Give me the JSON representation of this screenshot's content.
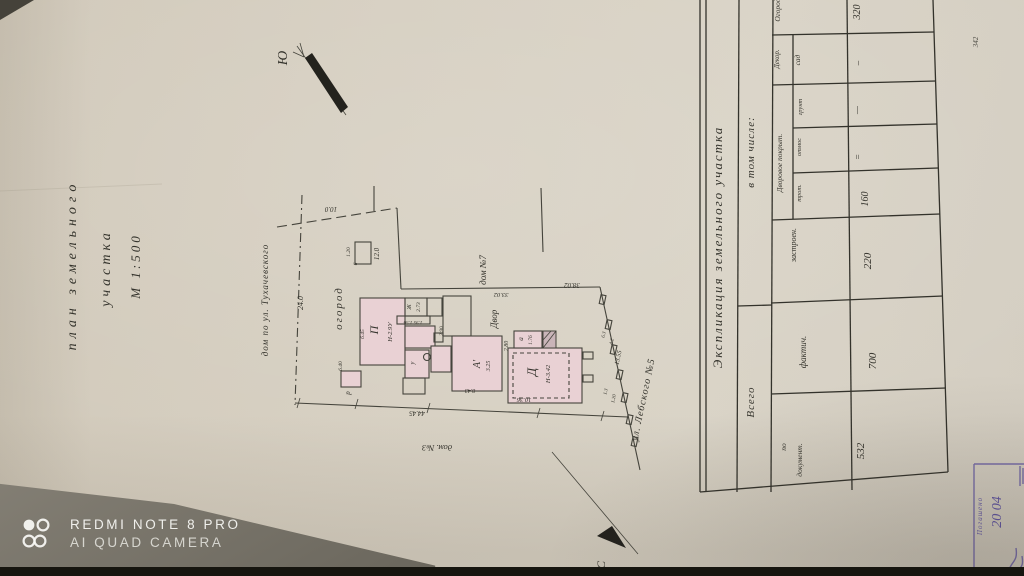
{
  "photo": {
    "watermark_line1": "REDMI NOTE 8 PRO",
    "watermark_line2": "AI QUAD CAMERA"
  },
  "titleblock": {
    "line1": "план земельного",
    "line2": "участка",
    "line3": "М 1:500"
  },
  "compass": {
    "south": "Ю",
    "north": "С"
  },
  "plan": {
    "neighbor_rear": "дом по ул. Тухачевского",
    "garden": "огород",
    "house7": "дом №7",
    "house3": "дом. №3",
    "street": "ул. Лебского №5",
    "yard": "Двор",
    "dim_24": "24.0",
    "dim_10": "10.0",
    "dim_12": "12.0",
    "dim_120": "1.20",
    "dim_6": "6",
    "dim_3302": "33.02",
    "dim_3802": "38.02",
    "dim_4445": "44.45",
    "dim_1355": "13.55",
    "dim_13": "1.3",
    "dim_42": "4.2",
    "dim_63": "6.3",
    "dim_1036": "10.36",
    "dim_843": "8.43",
    "dim_280": "2.80",
    "dim_290": "2.90",
    "dim_273": "2.73",
    "dim_195156": "1.95 1.56",
    "dim_325": "3.25",
    "dim_176": "1.76",
    "dim_640": "6.40",
    "dim_645": "6.45",
    "bldg_P": "П",
    "bldg_P_h": "Н-2.9У",
    "bldg_D": "Д",
    "bldg_D_h": "Н-3.42",
    "bldg_A": "А'",
    "bldg_Zh": "Ж",
    "bldg_a": "а",
    "bldg_r": "р",
    "bldg_u": "у"
  },
  "table": {
    "title": "Экспликация  земельного  участка",
    "total": "Всего",
    "included": "в том числе:",
    "by_doc_1": "по",
    "by_doc_2": "документ.",
    "fact": "фактич.",
    "built": "застроен.",
    "yard_cover": "Дворовое покрыт.",
    "sidewalk": "трот.",
    "blind_area": "отмос",
    "ground": "грунт",
    "decor": "Декор.",
    "sad": "сад",
    "ogorod": "Огород",
    "v_by_doc": "532",
    "v_fact": "700",
    "v_built": "220",
    "v_sidewalk": "160",
    "v_blind": "=",
    "v_ground": "—",
    "v_decor_sad": "–",
    "v_ogorod": "320"
  },
  "stamp": {
    "text": "Погашено",
    "date": "20 04"
  },
  "pencil_note": "342"
}
